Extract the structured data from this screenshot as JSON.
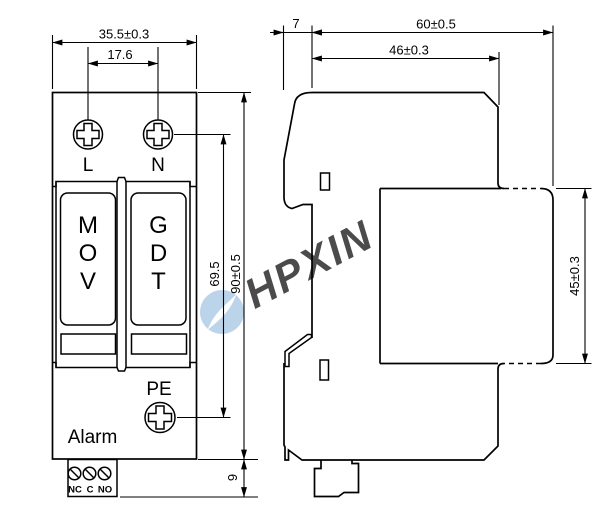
{
  "watermark": {
    "text": "HPXIN",
    "color": "#9fc2e2"
  },
  "front_view": {
    "dim_overall_width": "35.5±0.3",
    "dim_screw_spacing": "17.6",
    "dim_overall_height": "90±0.5",
    "dim_screw_centers": "69.5",
    "dim_terminal_depth": "9",
    "terminal_l": "L",
    "terminal_n": "N",
    "terminal_pe": "PE",
    "alarm_label": "Alarm",
    "alarm_contacts": [
      "NC",
      "C",
      "NO"
    ],
    "modules": [
      {
        "name": "MOV module",
        "letters": [
          "M",
          "O",
          "V"
        ]
      },
      {
        "name": "GDT module",
        "letters": [
          "G",
          "D",
          "T"
        ]
      }
    ],
    "indicator_color": "#00ee00"
  },
  "side_view": {
    "dim_clip": "7",
    "dim_overall_depth": "60±0.5",
    "dim_body_depth": "46±0.3",
    "dim_module_height": "45±0.3"
  }
}
